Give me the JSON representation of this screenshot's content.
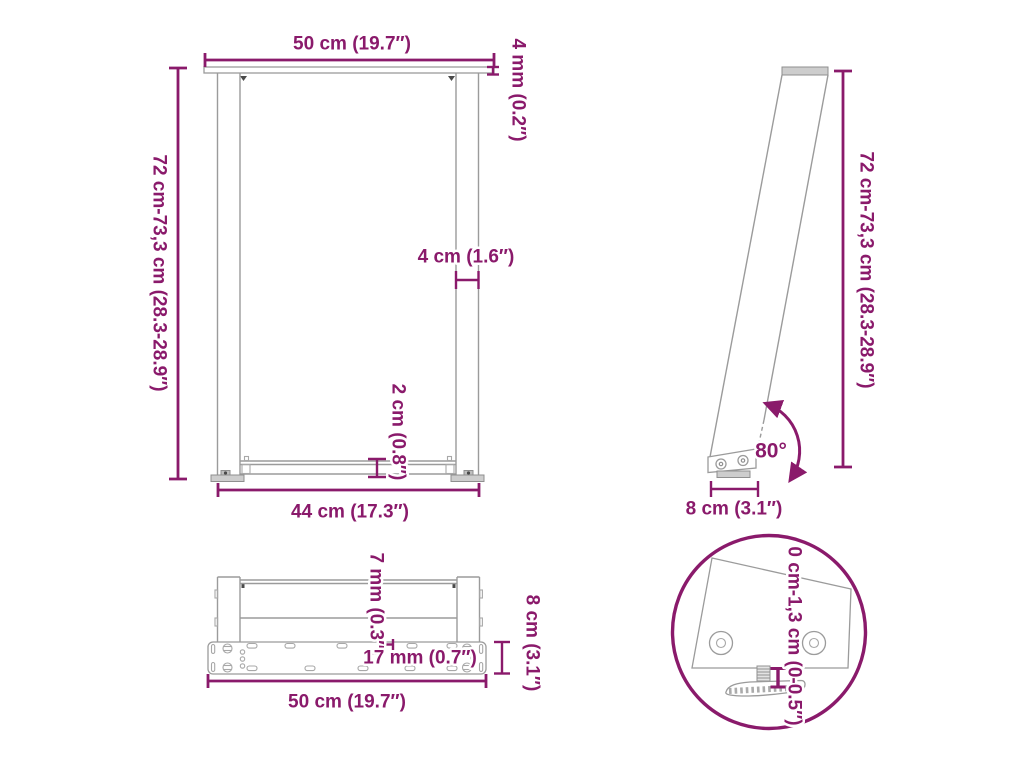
{
  "colors": {
    "accent": "#8A1A6B",
    "line_gray": "#9B9B9B",
    "fill_gray": "#CDCDCD",
    "background": "#FFFFFF"
  },
  "views": {
    "front": {
      "top_width": "50 cm (19.7″)",
      "plate_thickness": "4 mm (0.2″)",
      "height_range": "72 cm-73,3 cm (28.3-28.9″)",
      "leg_profile_width": "4 cm (1.6″)",
      "crossbar_height": "2 cm (0.8″)",
      "bottom_width": "44 cm (17.3″)"
    },
    "side": {
      "height_range": "72 cm-73,3 cm (28.3-28.9″)",
      "leg_angle": "80°",
      "foot_depth": "8 cm (3.1″)"
    },
    "base": {
      "slot_width": "7 mm (0.3″)",
      "hole_spacing": "17 mm (0.7″)",
      "plate_depth": "8 cm (3.1″)",
      "plate_width": "50 cm (19.7″)"
    },
    "detail": {
      "adjustable_foot_range": "0 cm-1,3 cm (0-0.5″)"
    }
  }
}
